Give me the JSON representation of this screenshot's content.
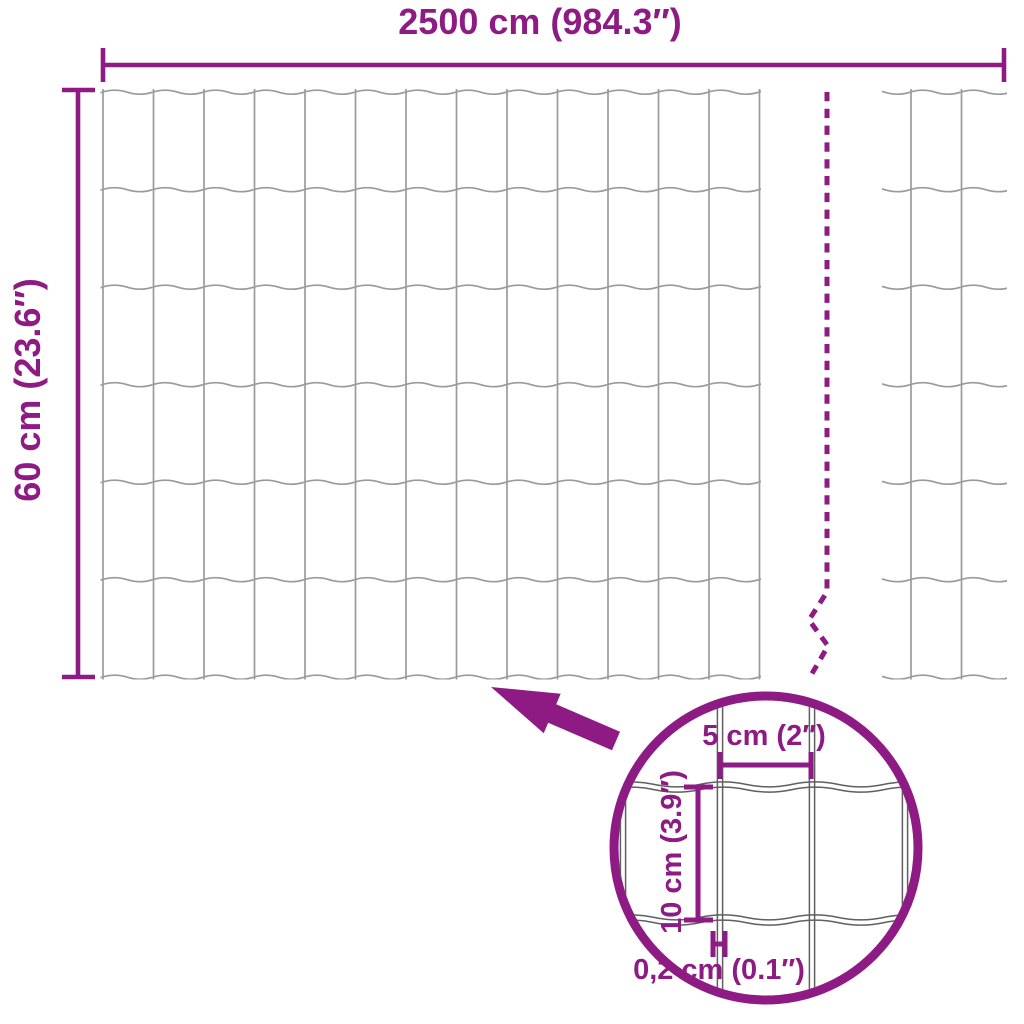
{
  "colors": {
    "accent": "#8E1B84",
    "wire": "#9A9A9A",
    "detail_wire": "#5F5F5F",
    "background": "#FFFFFF"
  },
  "dimensions": {
    "width": {
      "label": "2500 cm (984.3″)"
    },
    "height": {
      "label": "60 cm (23.6″)"
    }
  },
  "detail_view": {
    "cell_width": {
      "label": "5 cm (2″)"
    },
    "cell_height": {
      "label": "10 cm (3.9″)"
    },
    "wire_thickness": {
      "label": "0,2 cm (0.1″)"
    }
  }
}
